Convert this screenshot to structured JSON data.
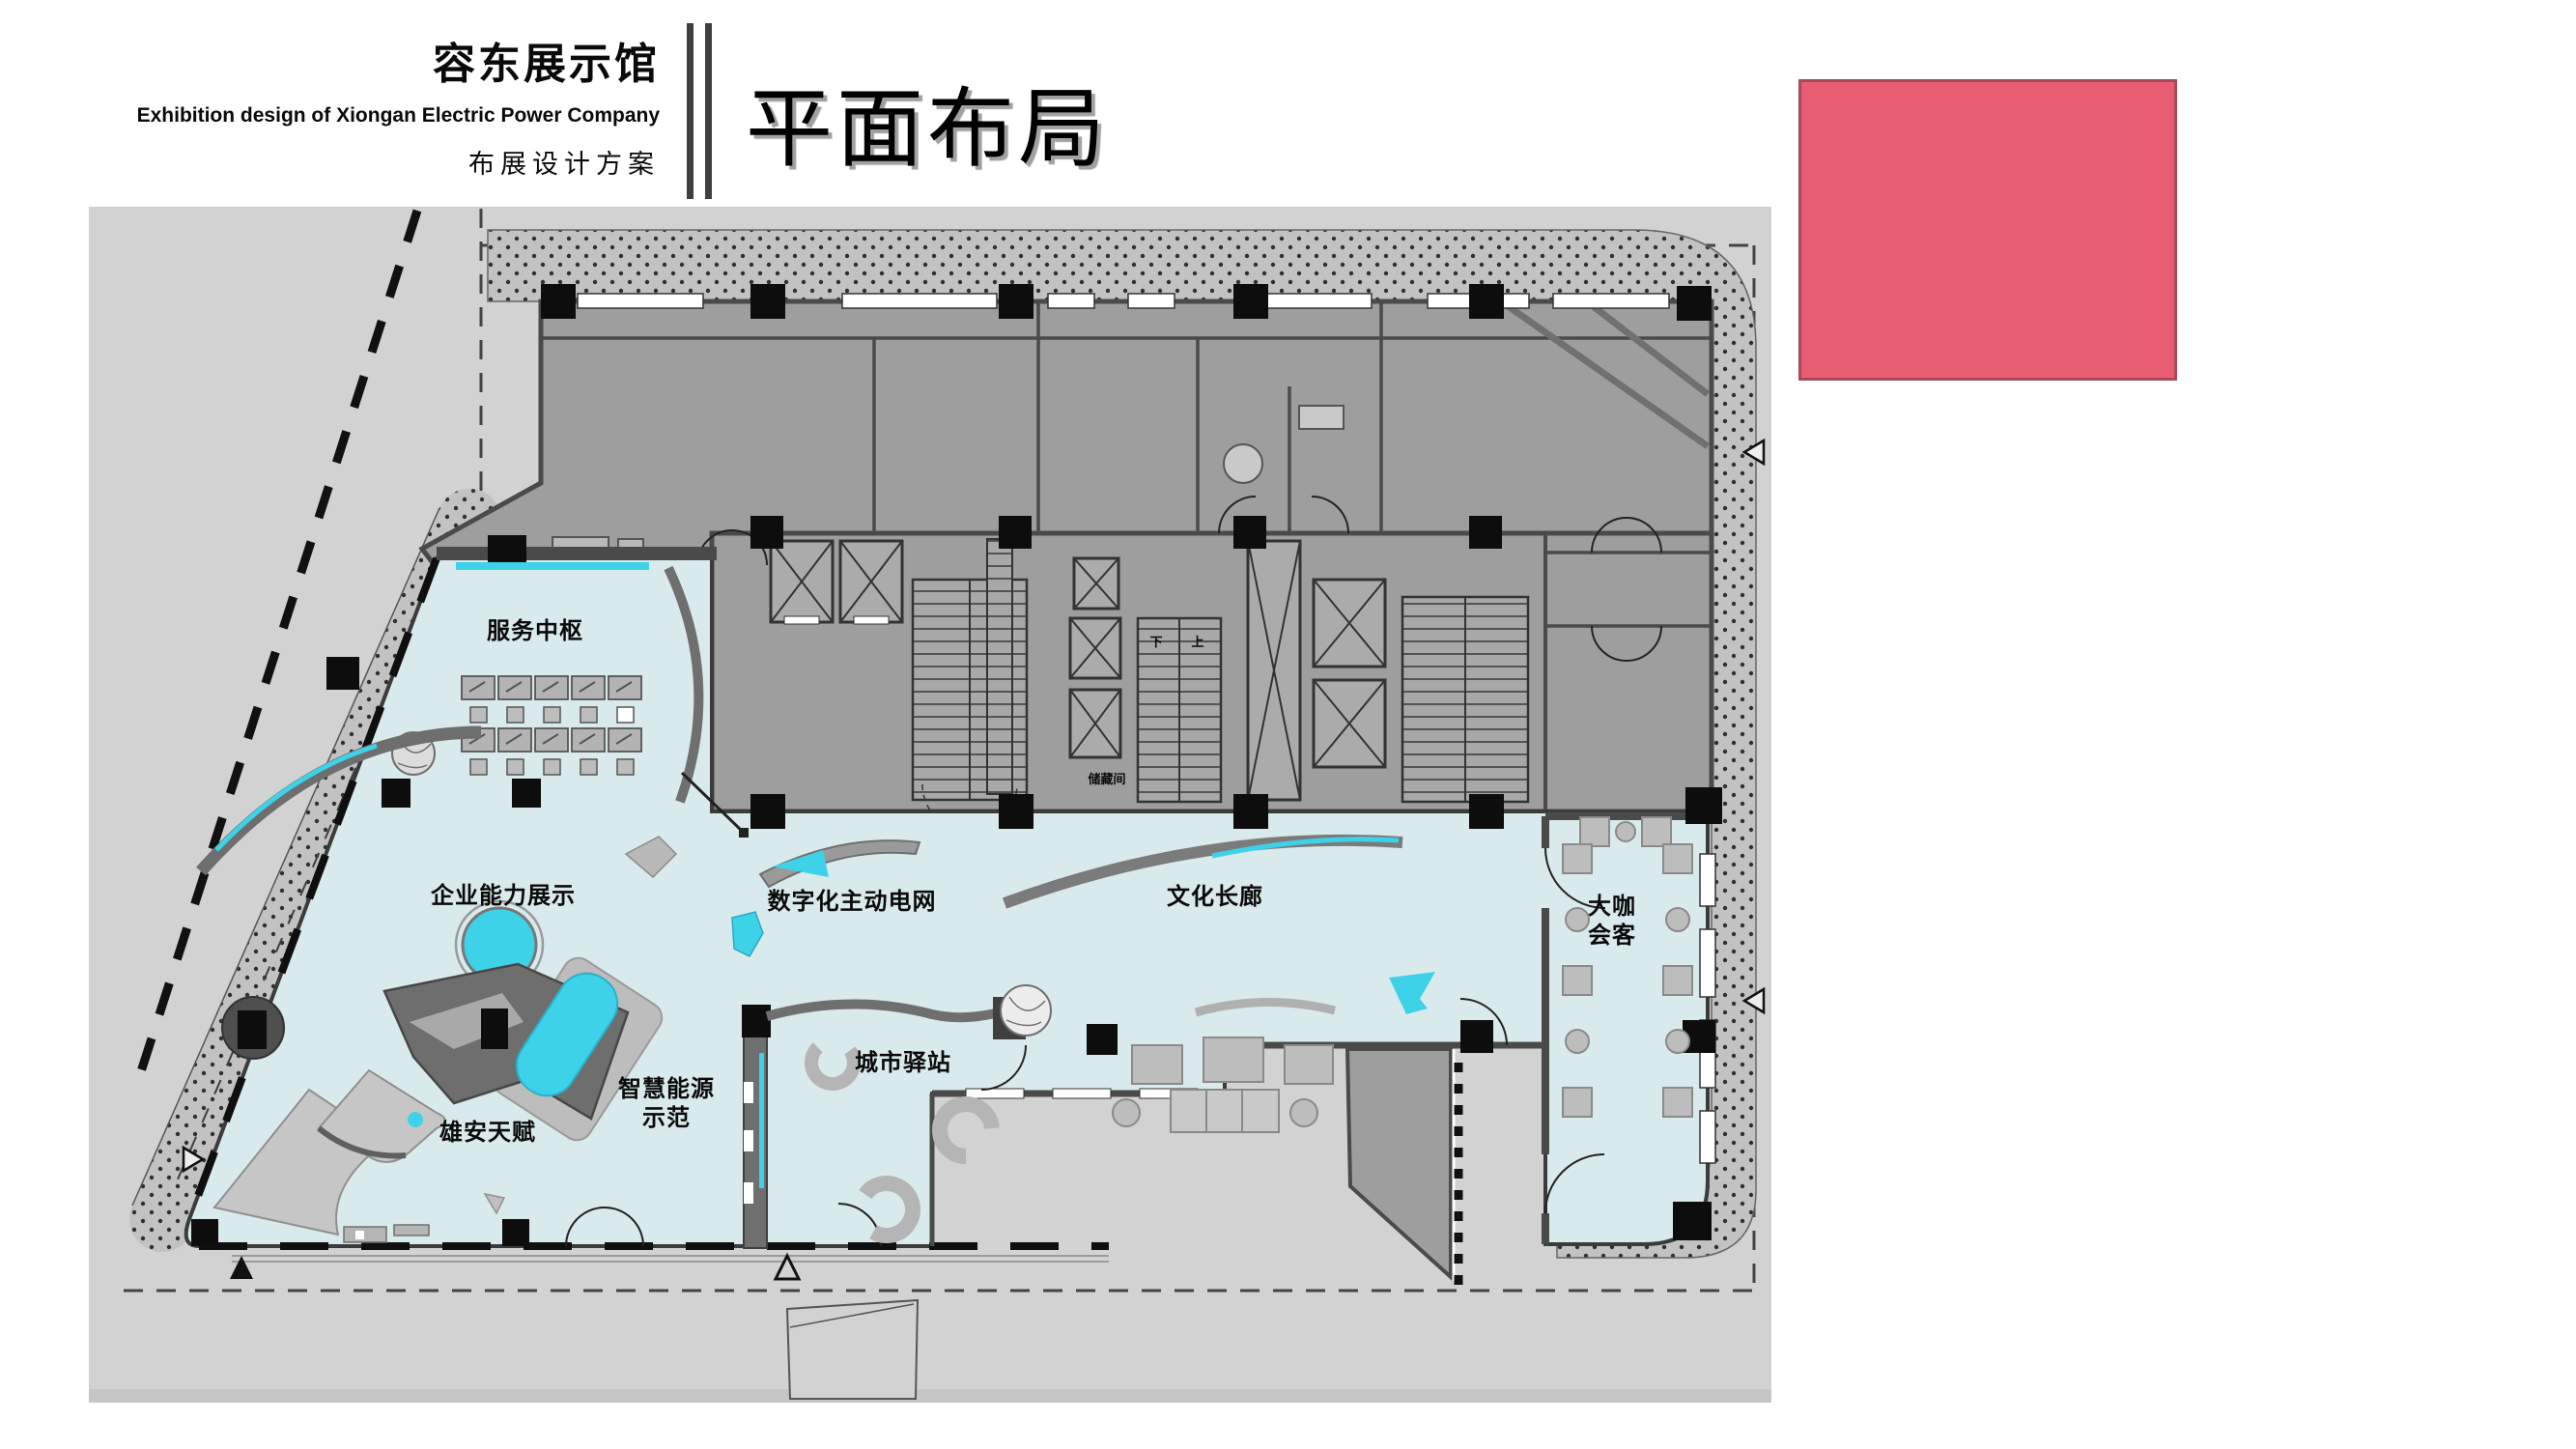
{
  "header": {
    "title_cn": "容东展示馆",
    "subtitle_en": "Exhibition design of Xiongan Electric Power Company",
    "subtitle_cn": "布展设计方案",
    "page_title": "平面布局"
  },
  "colors": {
    "accent_pink": "#e85d72",
    "accent_cyan": "#3dd2e8",
    "floor_cyan": "#d9eaec",
    "wall_dark": "#4a4a4a",
    "room_gray": "#9e9e9e",
    "site_gray": "#d2d2d2"
  },
  "floor_plan": {
    "zones": [
      {
        "id": "service-hub",
        "label": "服务中枢"
      },
      {
        "id": "enterprise-capability",
        "label": "企业能力展示"
      },
      {
        "id": "digital-active-grid",
        "label": "数字化主动电网"
      },
      {
        "id": "culture-corridor",
        "label": "文化长廊"
      },
      {
        "id": "vip-meeting",
        "label": "大咖\n会客"
      },
      {
        "id": "smart-energy-demo",
        "label": "智慧能源\n示范"
      },
      {
        "id": "city-station",
        "label": "城市驿站"
      },
      {
        "id": "xiongan-talent",
        "label": "雄安天赋"
      }
    ],
    "small_labels": [
      {
        "id": "storage-room",
        "label": "储藏间"
      },
      {
        "id": "stair-down",
        "label": "下"
      },
      {
        "id": "stair-up",
        "label": "上"
      }
    ]
  }
}
